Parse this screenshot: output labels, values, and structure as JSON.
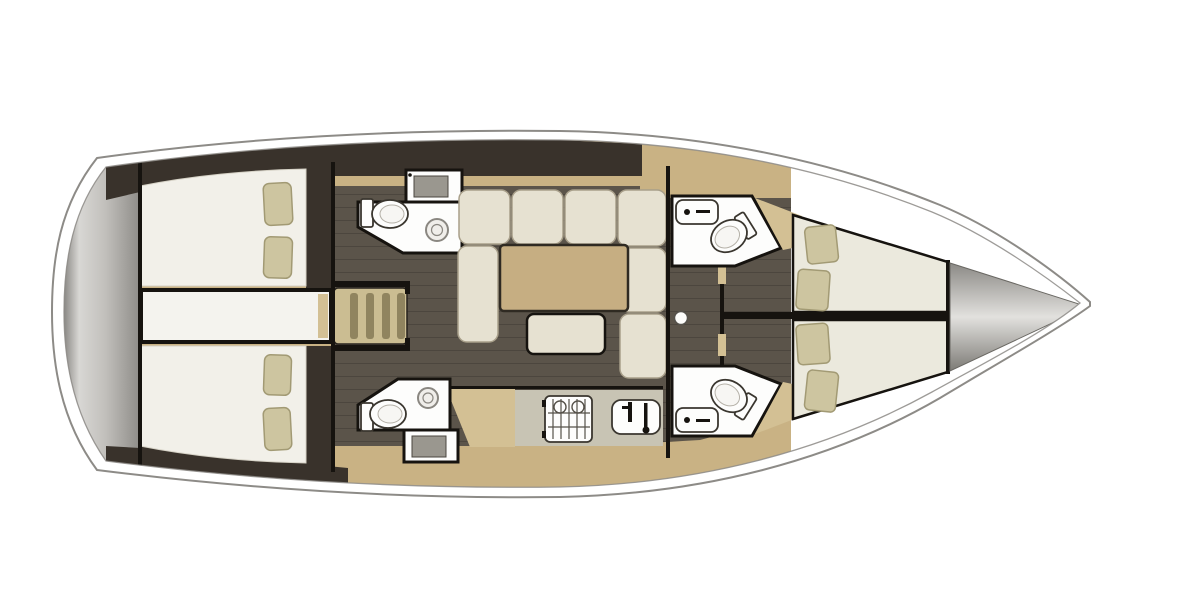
{
  "diagram": {
    "type": "yacht-interior-floorplan",
    "orientation": "bow-right",
    "background": "#ffffff"
  },
  "labels": {
    "boat": "sailing-yacht-floorplan-top-view",
    "transom": "stern-swim-platform",
    "aft_cabin_port": "aft-cabin-port-double-berth",
    "aft_cabin_stbd": "aft-cabin-starboard-double-berth",
    "engine": "engine-compartment",
    "stairs": "companionway-steps",
    "head_aft_port": "bathroom-aft-port",
    "head_aft_stbd": "bathroom-aft-starboard",
    "saloon": "saloon-u-shaped-sofa-with-table",
    "galley": "galley-with-stove-and-sink",
    "mast": "mast-foot",
    "head_fwd_port": "bathroom-forward-port",
    "head_fwd_stbd": "bathroom-forward-starboard",
    "fwd_cabin_port": "forward-v-berth-port",
    "fwd_cabin_stbd": "forward-v-berth-starboard",
    "anchor": "anchor-locker-bow"
  },
  "palette": {
    "hull_line": "#8d8b87",
    "transom_dark": "#807e79",
    "transom_mid": "#b7b5b1",
    "transom_light": "#dcdbd8",
    "cabinetry": "#39322b",
    "wood": "#c9b284",
    "wood_light": "#d3c094",
    "floor": "#5b544a",
    "mattress": "#f2f0e9",
    "berth": "#ebe9dd",
    "pillow": "#cdc5a0",
    "pillow_edge": "#a29a74",
    "sofa": "#e6e1d1",
    "sofa_edge": "#a89f8a",
    "table": "#c6ae82",
    "counter": "#c8c4b4",
    "fixture": "#fdfdfc",
    "steel": "#9a978f",
    "ink": "#16130f",
    "stair": "#cbbd92",
    "slat": "#90845f",
    "cone_dark": "#84827d",
    "cone_light": "#e2e1de"
  }
}
